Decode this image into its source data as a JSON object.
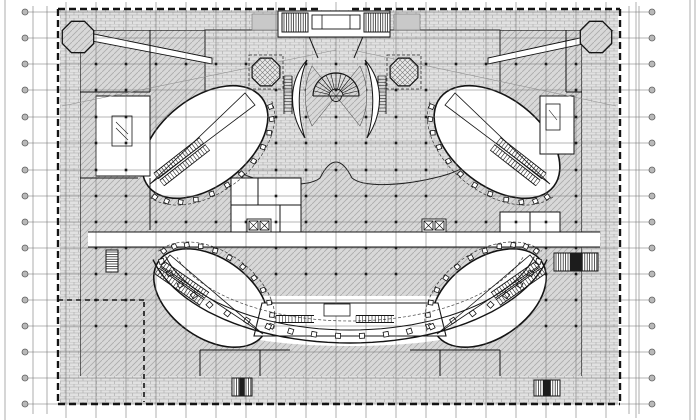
{
  "canvas": {
    "width": 700,
    "height": 420,
    "background": "#ffffff"
  },
  "palette": {
    "ink": "#141414",
    "grid_line": "#6f6f6f",
    "sheet_line": "#9a9a9a",
    "bubble_fill": "#b9b9b9",
    "bubble_ring": "#5f5f5f",
    "hatch_bg": "#d8d8d8",
    "hatch_ln": "#ababab",
    "brick_bg": "#e1e1e1",
    "brick_ln": "#a8a8a8",
    "cross_bg": "#e8e8e8",
    "cross_ln": "#787878",
    "white": "#ffffff",
    "dark": "#1c1c1c",
    "planter": "#c9c9c9"
  },
  "sheet_lines": [
    [
      5,
      0,
      5,
      420
    ],
    [
      33,
      6,
      33,
      414
    ],
    [
      47,
      6,
      47,
      414
    ],
    [
      629,
      6,
      629,
      414
    ],
    [
      639,
      6,
      639,
      414
    ],
    [
      690,
      0,
      690,
      420
    ],
    [
      695,
      0,
      695,
      420
    ]
  ],
  "grid": {
    "vx_start": 66,
    "vx_step": 30,
    "vx_count": 20,
    "vy1": 2,
    "vy2": 418,
    "h_ys": [
      12,
      38,
      64,
      90,
      117,
      143,
      170,
      196,
      222,
      248,
      274,
      300,
      326,
      352,
      378,
      404
    ],
    "hx1": 25,
    "hx2": 652,
    "bubble_left_x": 25,
    "bubble_right_x": 652,
    "bubble_r": 3
  },
  "columns": {
    "xs_start": 96,
    "xs_step": 30,
    "xs_count": 17,
    "ys": [
      64,
      90,
      117,
      143,
      170,
      196,
      222,
      248,
      274,
      300,
      326
    ],
    "size": 2.6,
    "exclude": [
      [
        139,
        85,
        132,
        114
      ],
      [
        431,
        85,
        132,
        114
      ],
      [
        155,
        245,
        112,
        106
      ],
      [
        423,
        245,
        112,
        106
      ],
      [
        160,
        290,
        380,
        58
      ],
      [
        88,
        230,
        512,
        18
      ]
    ]
  },
  "boundary": {
    "dash": "7 4",
    "width": 2.4,
    "segments": [
      [
        58,
        9,
        320,
        9
      ],
      [
        352,
        9,
        620,
        9
      ],
      [
        58,
        9,
        58,
        404
      ],
      [
        620,
        9,
        620,
        404
      ],
      [
        58,
        404,
        620,
        404
      ]
    ],
    "inner_dash": "5 4",
    "inner_width": 1.6,
    "inner_segments": [
      [
        144,
        302,
        144,
        402
      ],
      [
        58,
        300,
        144,
        300
      ]
    ]
  },
  "fills": [
    {
      "t": "rect",
      "x": 80,
      "y": 30,
      "w": 502,
      "h": 348,
      "f": "hatch",
      "s": "#141414",
      "sw": 1.2
    },
    {
      "t": "rect",
      "x": 60,
      "y": 10,
      "w": 558,
      "h": 20,
      "f": "brick"
    },
    {
      "t": "rect",
      "x": 60,
      "y": 10,
      "w": 20,
      "h": 394,
      "f": "brick"
    },
    {
      "t": "rect",
      "x": 582,
      "y": 10,
      "w": 36,
      "h": 394,
      "f": "brick"
    },
    {
      "t": "rect",
      "x": 60,
      "y": 376,
      "w": 558,
      "h": 28,
      "f": "brick"
    },
    {
      "t": "path",
      "d": "M205,30 L500,30 L500,112 C496,148 472,168 442,176 C404,186 364,188 352,178 Q336,146 320,178 C308,188 268,186 238,172 C214,160 205,134 205,112 Z",
      "f": "brick",
      "s": "#222222",
      "sw": 1
    },
    {
      "t": "poly",
      "pts": "84,32 212,58 212,64 92,41",
      "f": "#ffffff",
      "s": "#141414",
      "sw": 0.9
    },
    {
      "t": "poly",
      "pts": "612,31 488,58 488,64 602,40",
      "f": "#ffffff",
      "s": "#141414",
      "sw": 0.9
    },
    {
      "t": "path",
      "d": "M166,296 L534,296 C520,322 470,346 350,346 C230,346 180,322 166,296 Z",
      "f": "#ffffff"
    },
    {
      "t": "rect",
      "x": 88,
      "y": 232,
      "w": 512,
      "h": 15,
      "f": "#ffffff"
    },
    {
      "t": "ellipse",
      "cx": 205,
      "cy": 142,
      "rx": 72,
      "ry": 44,
      "rot": -38,
      "f": "#ffffff",
      "s": "#141414",
      "sw": 1.6
    },
    {
      "t": "ellipse",
      "cx": 497,
      "cy": 142,
      "rx": 72,
      "ry": 44,
      "rot": 38,
      "f": "#ffffff",
      "s": "#141414",
      "sw": 1.6
    },
    {
      "t": "ellipse",
      "cx": 211,
      "cy": 298,
      "rx": 64,
      "ry": 40,
      "rot": 35,
      "f": "#ffffff",
      "s": "#141414",
      "sw": 1.6
    },
    {
      "t": "ellipse",
      "cx": 489,
      "cy": 298,
      "rx": 64,
      "ry": 40,
      "rot": -35,
      "f": "#ffffff",
      "s": "#141414",
      "sw": 1.6
    },
    {
      "t": "rect",
      "x": 231,
      "y": 178,
      "w": 70,
      "h": 54,
      "f": "#ffffff",
      "s": "#141414",
      "sw": 1
    },
    {
      "t": "rect",
      "x": 96,
      "y": 96,
      "w": 54,
      "h": 80,
      "f": "#ffffff",
      "s": "#141414",
      "sw": 1
    },
    {
      "t": "rect",
      "x": 540,
      "y": 96,
      "w": 34,
      "h": 58,
      "f": "#ffffff",
      "s": "#141414",
      "sw": 1
    },
    {
      "t": "rect",
      "x": 500,
      "y": 212,
      "w": 60,
      "h": 20,
      "f": "#ffffff",
      "s": "#141414",
      "sw": 1
    },
    {
      "t": "poly",
      "pts": "262,303 438,303 446,336 254,336",
      "f": "#ffffff",
      "s": "#141414",
      "sw": 1.1
    },
    {
      "t": "rect",
      "x": 252,
      "y": 14,
      "w": 26,
      "h": 16,
      "f": "#c9c9c9",
      "s": "#777777",
      "sw": 0.6
    },
    {
      "t": "rect",
      "x": 394,
      "y": 14,
      "w": 26,
      "h": 16,
      "f": "#c9c9c9",
      "s": "#777777",
      "sw": 0.6
    }
  ],
  "walls": [
    [
      88,
      232,
      600,
      232
    ],
    [
      88,
      247,
      600,
      247
    ],
    [
      80,
      92,
      150,
      92
    ],
    [
      150,
      30,
      150,
      92
    ],
    [
      80,
      178,
      138,
      178
    ],
    [
      150,
      178,
      150,
      230
    ],
    [
      231,
      205,
      301,
      205
    ],
    [
      258,
      178,
      258,
      205
    ],
    [
      280,
      205,
      280,
      232
    ],
    [
      530,
      212,
      530,
      232
    ],
    [
      308,
      34,
      318,
      58
    ],
    [
      364,
      34,
      354,
      58
    ],
    [
      200,
      350,
      290,
      350
    ],
    [
      410,
      350,
      500,
      350
    ],
    [
      200,
      350,
      200,
      376
    ],
    [
      260,
      350,
      260,
      376
    ],
    [
      440,
      350,
      440,
      376
    ],
    [
      500,
      350,
      500,
      376
    ],
    [
      566,
      30,
      566,
      92
    ],
    [
      566,
      92,
      582,
      92
    ]
  ],
  "details": [
    {
      "t": "line",
      "x1": 62,
      "y1": 106,
      "x2": 336,
      "y2": 50,
      "s": "#8f8f8f",
      "sw": 0.6
    },
    {
      "t": "line",
      "x1": 616,
      "y1": 106,
      "x2": 352,
      "y2": 50,
      "s": "#8f8f8f",
      "sw": 0.6
    },
    {
      "t": "arc",
      "cx": 205,
      "cy": 142,
      "rx": 79,
      "ry": 51,
      "rot": -38,
      "a1": 10,
      "a2": 170,
      "s": "#333333",
      "sw": 0.7,
      "dash": "3 2"
    },
    {
      "t": "arc",
      "cx": 497,
      "cy": 142,
      "rx": 79,
      "ry": 51,
      "rot": 38,
      "a1": 10,
      "a2": 170,
      "s": "#333333",
      "sw": 0.7,
      "dash": "3 2"
    },
    {
      "t": "arc",
      "cx": 211,
      "cy": 298,
      "rx": 71,
      "ry": 47,
      "rot": 35,
      "a1": 190,
      "a2": 350,
      "s": "#333333",
      "sw": 0.7,
      "dash": "3 2"
    },
    {
      "t": "arc",
      "cx": 489,
      "cy": 298,
      "rx": 71,
      "ry": 47,
      "rot": -35,
      "a1": 190,
      "a2": 350,
      "s": "#333333",
      "sw": 0.7,
      "dash": "3 2"
    },
    {
      "t": "colon",
      "cx": 205,
      "cy": 142,
      "rx": 76,
      "ry": 48,
      "rot": -38,
      "a1": 15,
      "a2": 165,
      "n": 12,
      "size": 4.5
    },
    {
      "t": "colon",
      "cx": 497,
      "cy": 142,
      "rx": 76,
      "ry": 48,
      "rot": 38,
      "a1": 15,
      "a2": 165,
      "n": 12,
      "size": 4.5
    },
    {
      "t": "colon",
      "cx": 211,
      "cy": 298,
      "rx": 68,
      "ry": 44,
      "rot": 35,
      "a1": 195,
      "a2": 345,
      "n": 12,
      "size": 4.5
    },
    {
      "t": "colon",
      "cx": 489,
      "cy": 298,
      "rx": 68,
      "ry": 44,
      "rot": -35,
      "a1": 195,
      "a2": 345,
      "n": 12,
      "size": 4.5
    },
    {
      "t": "arc",
      "cx": 350,
      "cy": 233,
      "rx": 203,
      "ry": 110,
      "rot": 0,
      "a1": 14,
      "a2": 166,
      "s": "#141414",
      "sw": 1.4
    },
    {
      "t": "arc",
      "cx": 350,
      "cy": 233,
      "rx": 190,
      "ry": 97,
      "rot": 0,
      "a1": 14,
      "a2": 166,
      "s": "#141414",
      "sw": 1
    },
    {
      "t": "arc",
      "cx": 350,
      "cy": 233,
      "rx": 180,
      "ry": 88,
      "rot": 0,
      "a1": 16,
      "a2": 164,
      "s": "#444444",
      "sw": 0.7,
      "dash": "3 2"
    },
    {
      "t": "colon",
      "cx": 350,
      "cy": 233,
      "rx": 196,
      "ry": 103,
      "rot": 0,
      "a1": 16,
      "a2": 164,
      "n": 22,
      "size": 5
    },
    {
      "t": "esc",
      "x": 156,
      "y": 176,
      "len": 58,
      "w": 7,
      "ang": -38
    },
    {
      "t": "esc",
      "x": 162,
      "y": 183,
      "len": 58,
      "w": 7,
      "ang": -38
    },
    {
      "t": "esc",
      "x": 544,
      "y": 176,
      "len": 58,
      "w": 7,
      "ang": 218
    },
    {
      "t": "esc",
      "x": 538,
      "y": 183,
      "len": 58,
      "w": 7,
      "ang": 218
    },
    {
      "t": "esc",
      "x": 162,
      "y": 264,
      "len": 55,
      "w": 7,
      "ang": 35
    },
    {
      "t": "esc",
      "x": 157,
      "y": 271,
      "len": 55,
      "w": 7,
      "ang": 35
    },
    {
      "t": "esc",
      "x": 538,
      "y": 264,
      "len": 55,
      "w": 7,
      "ang": 145
    },
    {
      "t": "esc",
      "x": 543,
      "y": 271,
      "len": 55,
      "w": 7,
      "ang": 145
    },
    {
      "t": "esc",
      "x": 276,
      "y": 319,
      "len": 38,
      "w": 7,
      "ang": 0
    },
    {
      "t": "esc",
      "x": 356,
      "y": 319,
      "len": 38,
      "w": 7,
      "ang": 0
    },
    {
      "t": "esc",
      "x": 288,
      "y": 76,
      "len": 38,
      "w": 8,
      "ang": 90
    },
    {
      "t": "esc",
      "x": 382,
      "y": 76,
      "len": 38,
      "w": 8,
      "ang": 90
    },
    {
      "t": "poly",
      "pts": "150,184 245,93 255,105",
      "f": "none",
      "s": "#141414",
      "sw": 0.8
    },
    {
      "t": "poly",
      "pts": "550,184 455,93 445,105",
      "f": "none",
      "s": "#141414",
      "sw": 0.8
    },
    {
      "t": "poly",
      "pts": "263,334 170,255 161,266",
      "f": "none",
      "s": "#141414",
      "sw": 0.8
    },
    {
      "t": "poly",
      "pts": "437,334 530,255 539,266",
      "f": "none",
      "s": "#141414",
      "sw": 0.8
    },
    {
      "t": "path",
      "d": "M312,66 L336,96 L312,126 C303,107 303,85 312,66 Z",
      "f": "hatch",
      "s": "#555555",
      "sw": 0.6
    },
    {
      "t": "path",
      "d": "M360,66 L336,96 L360,126 C369,107 369,85 360,66 Z",
      "f": "hatch",
      "s": "#555555",
      "sw": 0.6
    },
    {
      "t": "fan",
      "cx": 336,
      "cy": 96,
      "r": 23,
      "ri": 7,
      "a1": 180,
      "a2": 360,
      "n": 14
    },
    {
      "t": "path",
      "d": "M307,60 C288,82 288,112 305,138 C297,115 297,83 307,60 Z",
      "f": "#ffffff",
      "s": "#141414",
      "sw": 1
    },
    {
      "t": "path",
      "d": "M365,60 C384,82 384,112 367,138 C375,115 375,83 365,60 Z",
      "f": "#ffffff",
      "s": "#141414",
      "sw": 1
    },
    {
      "t": "octo",
      "cx": 78,
      "cy": 37,
      "r": 17,
      "f": "hatch",
      "sw": 1.3
    },
    {
      "t": "octo",
      "cx": 596,
      "cy": 37,
      "r": 17,
      "f": "hatch",
      "sw": 1.3
    },
    {
      "t": "rect",
      "x": 249,
      "y": 55,
      "w": 34,
      "h": 34,
      "f": "none",
      "s": "#333333",
      "sw": 0.8,
      "dash": "3 2"
    },
    {
      "t": "rect",
      "x": 387,
      "y": 55,
      "w": 34,
      "h": 34,
      "f": "none",
      "s": "#333333",
      "sw": 0.8,
      "dash": "3 2"
    },
    {
      "t": "octo",
      "cx": 266,
      "cy": 72,
      "r": 15,
      "f": "cross",
      "sw": 1.2
    },
    {
      "t": "octo",
      "cx": 404,
      "cy": 72,
      "r": 15,
      "f": "cross",
      "sw": 1.2
    },
    {
      "t": "rect",
      "x": 278,
      "y": 11,
      "w": 112,
      "h": 26,
      "f": "#ffffff",
      "s": "#141414",
      "sw": 1
    },
    {
      "t": "stair",
      "x": 282,
      "y": 13,
      "w": 26,
      "h": 19,
      "dir": "v",
      "dk": false
    },
    {
      "t": "stair",
      "x": 364,
      "y": 13,
      "w": 26,
      "h": 19,
      "dir": "v",
      "dk": false
    },
    {
      "t": "rect",
      "x": 312,
      "y": 15,
      "w": 48,
      "h": 14,
      "f": "#ffffff",
      "s": "#141414",
      "sw": 0.9
    },
    {
      "t": "line",
      "x1": 322,
      "y1": 15,
      "x2": 322,
      "y2": 29,
      "s": "#141414",
      "sw": 0.8
    },
    {
      "t": "line",
      "x1": 350,
      "y1": 15,
      "x2": 350,
      "y2": 29,
      "s": "#141414",
      "sw": 0.8
    },
    {
      "t": "stair",
      "x": 554,
      "y": 253,
      "w": 44,
      "h": 18,
      "dir": "v",
      "dk": true
    },
    {
      "t": "stair",
      "x": 232,
      "y": 378,
      "w": 20,
      "h": 18,
      "dir": "v",
      "dk": true
    },
    {
      "t": "stair",
      "x": 534,
      "y": 380,
      "w": 26,
      "h": 16,
      "dir": "v",
      "dk": true
    },
    {
      "t": "stair",
      "x": 106,
      "y": 250,
      "w": 12,
      "h": 22,
      "dir": "h",
      "dk": false
    },
    {
      "t": "elev",
      "x": 249,
      "y": 221,
      "s": 9
    },
    {
      "t": "elev",
      "x": 424,
      "y": 221,
      "s": 9
    },
    {
      "t": "rect",
      "x": 112,
      "y": 116,
      "w": 20,
      "h": 30,
      "f": "none",
      "s": "#141414",
      "sw": 0.8
    },
    {
      "t": "line",
      "x1": 116,
      "y1": 122,
      "x2": 128,
      "y2": 134,
      "s": "#141414",
      "sw": 0.6
    },
    {
      "t": "line",
      "x1": 116,
      "y1": 128,
      "x2": 128,
      "y2": 140,
      "s": "#141414",
      "sw": 0.6
    },
    {
      "t": "rect",
      "x": 546,
      "y": 104,
      "w": 14,
      "h": 26,
      "f": "none",
      "s": "#141414",
      "sw": 0.8
    },
    {
      "t": "line",
      "x1": 549,
      "y1": 110,
      "x2": 557,
      "y2": 120,
      "s": "#141414",
      "sw": 0.6
    },
    {
      "t": "rect",
      "x": 324,
      "y": 304,
      "w": 26,
      "h": 12,
      "f": "#ffffff",
      "s": "#141414",
      "sw": 0.8
    }
  ]
}
